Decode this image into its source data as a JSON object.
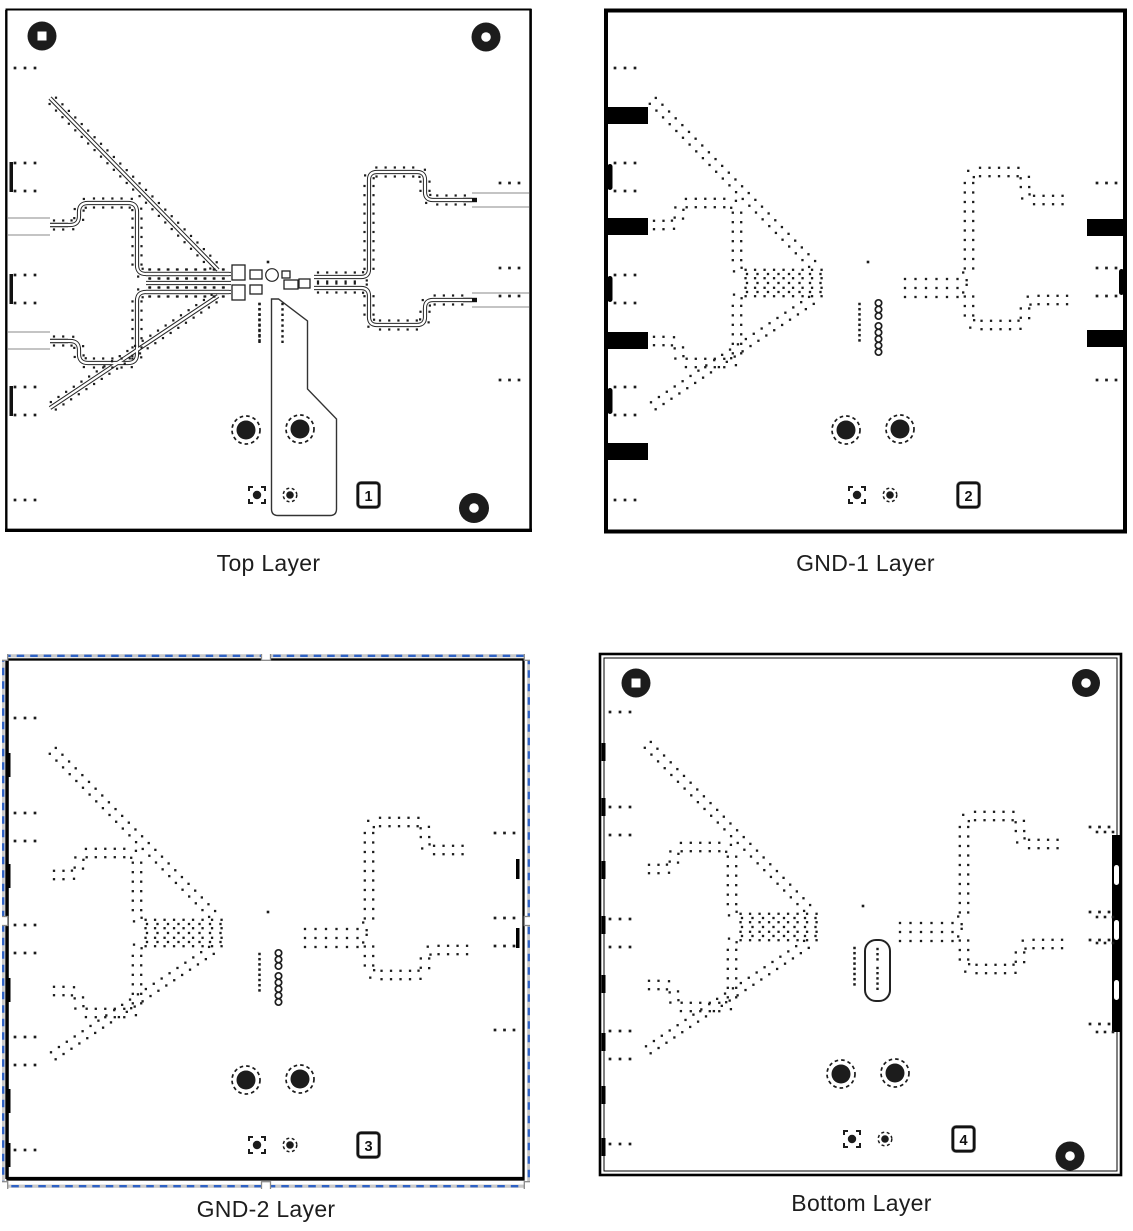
{
  "figure": {
    "panels": [
      {
        "caption": "Top Layer",
        "badge": "1",
        "type": "top",
        "selected": false
      },
      {
        "caption": "GND-1 Layer",
        "badge": "2",
        "type": "gnd1",
        "selected": false
      },
      {
        "caption": "GND-2 Layer",
        "badge": "3",
        "type": "gnd2",
        "selected": true
      },
      {
        "caption": "Bottom Layer",
        "badge": "4",
        "type": "bottom",
        "selected": false
      }
    ],
    "colors": {
      "ink": "#1c1c1c",
      "frame": "#000000",
      "trace_outline": "#2a2a2a",
      "selection_blue": "#2e62c5",
      "selection_underlay": "#c9c9c9",
      "handle_fill": "#ffffff",
      "handle_border": "#8a8a8a",
      "background": "#ffffff"
    }
  }
}
